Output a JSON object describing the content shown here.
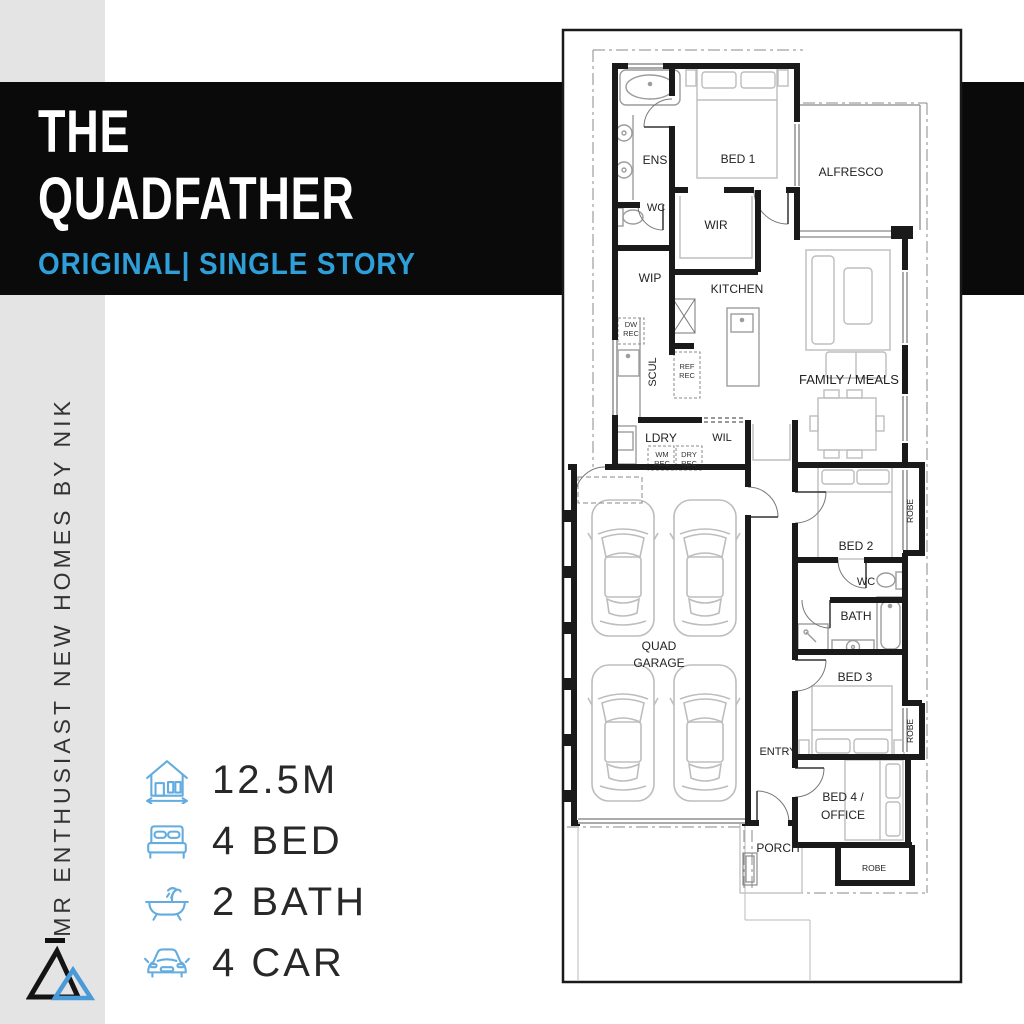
{
  "colors": {
    "banner_bg": "#0A0A0A",
    "accent_blue": "#2E9FD8",
    "icon_blue": "#63ACDF",
    "sidebar_bg": "#E4E4E4",
    "wall_black": "#1A1A1A"
  },
  "brand": {
    "sidebar_text": "MR ENTHUSIAST NEW HOMES BY NIK"
  },
  "banner": {
    "title_line1": "THE",
    "title_line2": "QUADFATHER",
    "subtitle": "ORIGINAL| SINGLE STORY"
  },
  "features": {
    "items": [
      {
        "icon": "house-width-icon",
        "label": "12.5M"
      },
      {
        "icon": "bed-icon",
        "label": "4 BED"
      },
      {
        "icon": "bath-icon",
        "label": "2 BATH"
      },
      {
        "icon": "car-icon",
        "label": "4 CAR"
      }
    ]
  },
  "floor_plan": {
    "rooms": [
      {
        "label": "ENS",
        "x": 655,
        "y": 164,
        "fs": 12
      },
      {
        "label": "WC",
        "x": 656,
        "y": 211,
        "fs": 11
      },
      {
        "label": "BED 1",
        "x": 738,
        "y": 163,
        "fs": 12
      },
      {
        "label": "ALFRESCO",
        "x": 851,
        "y": 176,
        "fs": 12
      },
      {
        "label": "WIR",
        "x": 716,
        "y": 229,
        "fs": 12
      },
      {
        "label": "WIP",
        "x": 650,
        "y": 282,
        "fs": 12
      },
      {
        "label": "KITCHEN",
        "x": 737,
        "y": 293,
        "fs": 12
      },
      {
        "label": "SCUL",
        "x": 656,
        "y": 372,
        "fs": 11,
        "rot": -90
      },
      {
        "label": "FAMILY / MEALS",
        "x": 849,
        "y": 384,
        "fs": 13
      },
      {
        "label": "LDRY",
        "x": 661,
        "y": 442,
        "fs": 12
      },
      {
        "label": "WIL",
        "x": 722,
        "y": 441,
        "fs": 11
      },
      {
        "label": "QUAD",
        "x": 659,
        "y": 650,
        "fs": 12
      },
      {
        "label": "GARAGE",
        "x": 659,
        "y": 667,
        "fs": 12
      },
      {
        "label": "BED 2",
        "x": 856,
        "y": 550,
        "fs": 12
      },
      {
        "label": "ROBE",
        "x": 913,
        "y": 511,
        "fs": 8.5,
        "rot": -90
      },
      {
        "label": "WC",
        "x": 866,
        "y": 585,
        "fs": 11
      },
      {
        "label": "BATH",
        "x": 856,
        "y": 620,
        "fs": 12
      },
      {
        "label": "BED 3",
        "x": 855,
        "y": 681,
        "fs": 12
      },
      {
        "label": "ROBE",
        "x": 913,
        "y": 731,
        "fs": 8.5,
        "rot": -90
      },
      {
        "label": "ENTRY",
        "x": 778,
        "y": 755,
        "fs": 11
      },
      {
        "label": "BED 4 /",
        "x": 843,
        "y": 801,
        "fs": 12
      },
      {
        "label": "OFFICE",
        "x": 843,
        "y": 819,
        "fs": 12
      },
      {
        "label": "ROBE",
        "x": 874,
        "y": 871,
        "fs": 8.5
      },
      {
        "label": "PORCH",
        "x": 778,
        "y": 852,
        "fs": 12
      }
    ],
    "fixture_labels": [
      {
        "label": "DW",
        "x": 631,
        "y": 327
      },
      {
        "label": "REC",
        "x": 631,
        "y": 336
      },
      {
        "label": "REF",
        "x": 687,
        "y": 369
      },
      {
        "label": "REC",
        "x": 687,
        "y": 378
      },
      {
        "label": "WM",
        "x": 662,
        "y": 457
      },
      {
        "label": "REC",
        "x": 662,
        "y": 466
      },
      {
        "label": "DRY",
        "x": 689,
        "y": 457
      },
      {
        "label": "REC",
        "x": 689,
        "y": 466
      }
    ]
  }
}
